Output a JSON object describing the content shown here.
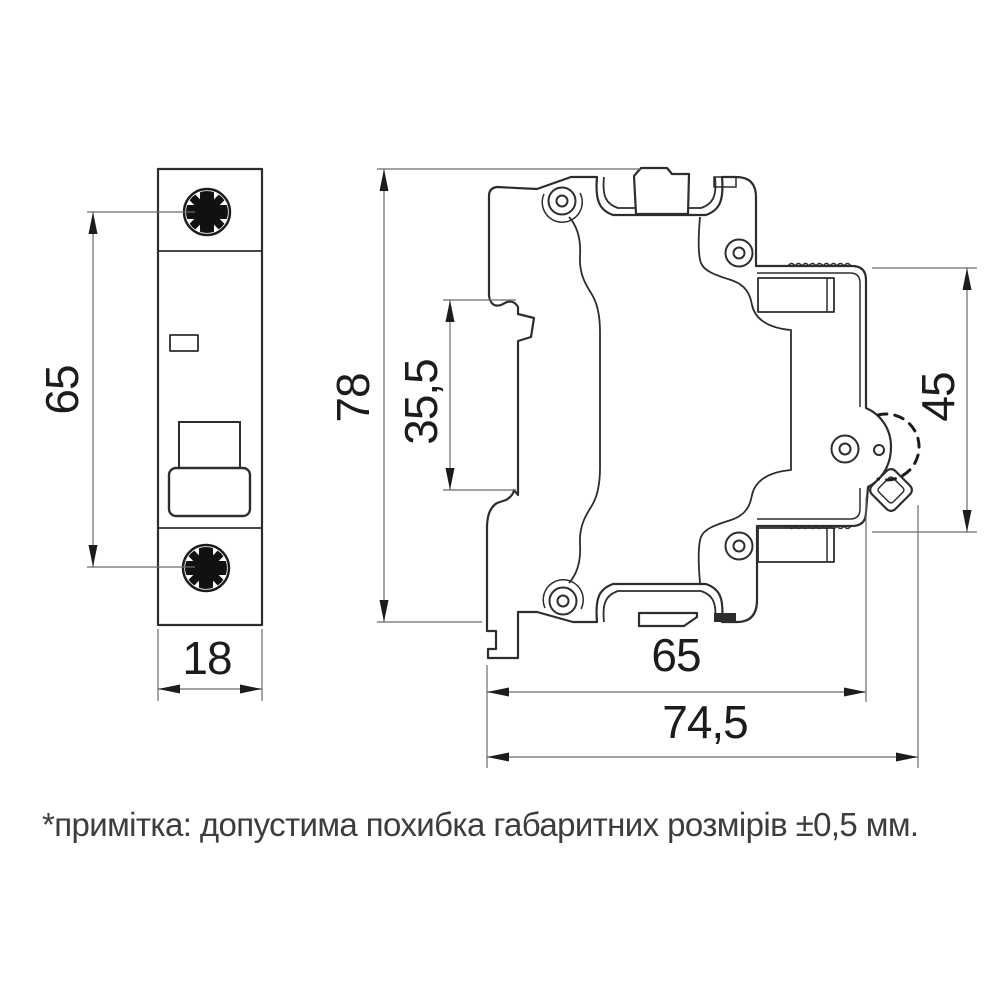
{
  "note": {
    "text": "*примітка: допустима похибка габаритних розмірів ±0,5 мм."
  },
  "dimensions": {
    "mounting_pitch": "65",
    "front_width": "18",
    "overall_height": "78",
    "din_slot_height": "35,5",
    "rear_height": "45",
    "body_depth": "65",
    "overall_depth": "74,5"
  },
  "colors": {
    "line": "#2d2d2d",
    "dim_line": "#6b6b6b",
    "background": "#ffffff"
  }
}
